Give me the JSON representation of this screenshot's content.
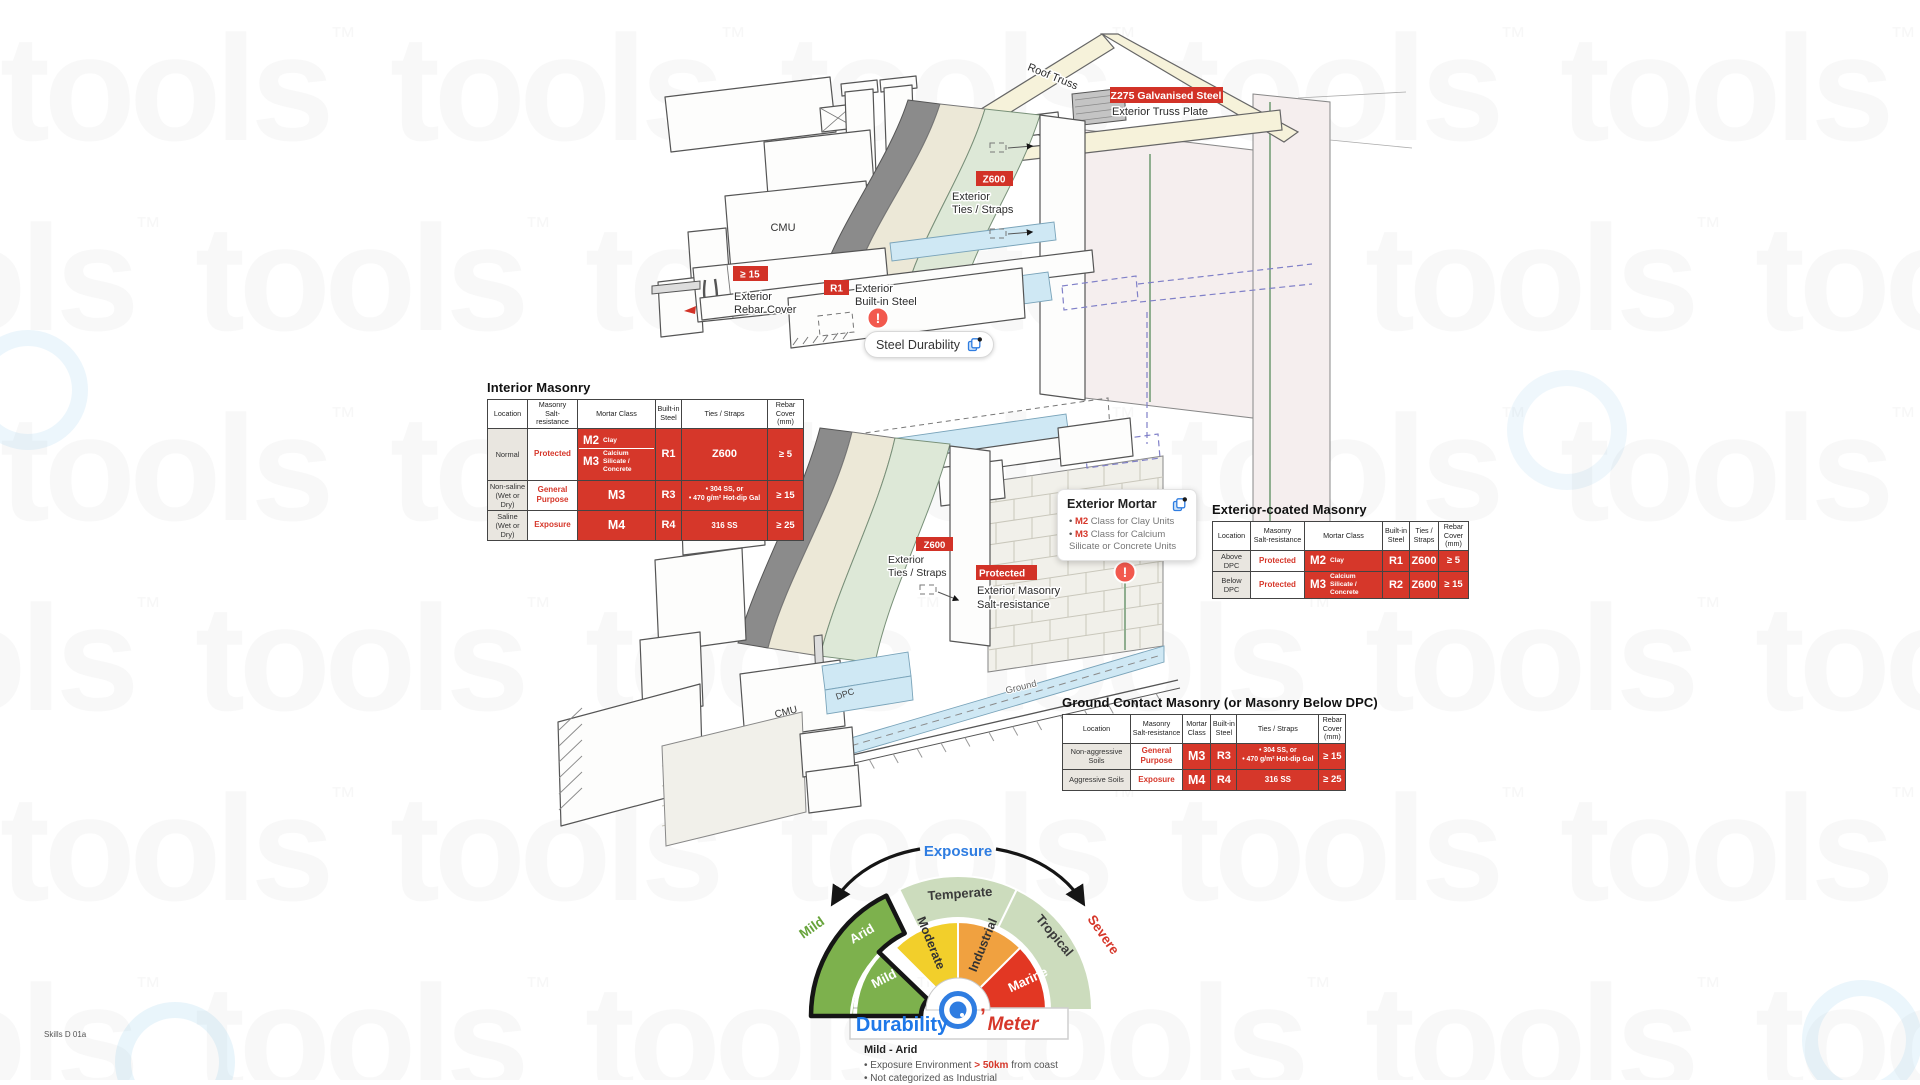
{
  "meta": {
    "footer_code": "Skills D 01a",
    "watermark": "tools"
  },
  "colors": {
    "badge_red": "#d23227",
    "table_red": "#d6372a",
    "accent_blue": "#2f7de1",
    "warn_red": "#f2594e",
    "green_sel": "#7db14d",
    "green_pale": "#ccdcbd",
    "yellow": "#f2cf2b",
    "orange": "#f0a140",
    "marine": "#e23723",
    "label_green": "#67a33a",
    "label_red": "#d6372a",
    "brand_blue": "#1e78e8"
  },
  "diagram": {
    "roof_truss": "Roof Truss",
    "z275_badge": "Z275 Galvanised Steel",
    "truss_plate": "Exterior Truss Plate",
    "cmu_upper": "CMU",
    "cmu_lower": "CMU",
    "dpc": "DPC",
    "ground": "Ground",
    "ties_upper": {
      "badge": "Z600",
      "l1": "Exterior",
      "l2": "Ties / Straps"
    },
    "ties_lower": {
      "badge": "Z600",
      "l1": "Exterior",
      "l2": "Ties / Straps"
    },
    "rebar": {
      "badge": "≥ 15",
      "l1": "Exterior",
      "l2": "Rebar Cover"
    },
    "builtin": {
      "badge": "R1",
      "l1": "Exterior",
      "l2": "Built-in Steel"
    },
    "salt": {
      "badge": "Protected",
      "l1": "Exterior Masonry",
      "l2": "Salt-resistance"
    },
    "steel_durability": "Steel Durability",
    "warning": "!",
    "mortar_card": {
      "title": "Exterior Mortar",
      "b1_code": "M2",
      "b1_text": " Class for Clay Units",
      "b2_code": "M3",
      "b2_text": " Class for Calcium Silicate or Concrete Units"
    }
  },
  "tables": [
    {
      "id": "interior",
      "title": "Interior Masonry",
      "headers": [
        "Location",
        "Masonry\nSalt-resistance",
        "Mortar Class",
        "Built-in\nSteel",
        "Ties / Straps",
        "Rebar\nCover\n(mm)"
      ],
      "rows": [
        {
          "location": "Normal",
          "salt": "Protected",
          "mortar": [
            {
              "code": "M2",
              "desc": "Clay"
            },
            {
              "code": "M3",
              "desc": "Calcium Silicate /\nConcrete"
            }
          ],
          "steel": "R1",
          "ties": [
            "Z600"
          ],
          "ties_style": "big",
          "rebar": "≥ 5"
        },
        {
          "location": "Non-saline\n(Wet or Dry)",
          "salt": "General\nPurpose",
          "mortar": [
            {
              "code": "M3",
              "desc": ""
            }
          ],
          "steel": "R3",
          "ties": [
            "• 304 SS, or",
            "• 470 g/m² Hot-dip Gal"
          ],
          "ties_style": "list",
          "rebar": "≥ 15"
        },
        {
          "location": "Saline\n(Wet or Dry)",
          "salt": "Exposure",
          "mortar": [
            {
              "code": "M4",
              "desc": ""
            }
          ],
          "steel": "R4",
          "ties": [
            "316 SS"
          ],
          "ties_style": "med",
          "rebar": "≥ 25"
        }
      ]
    },
    {
      "id": "exterior",
      "title": "Exterior-coated Masonry",
      "headers": [
        "Location",
        "Masonry\nSalt-resistance",
        "Mortar Class",
        "Built-in\nSteel",
        "Ties /\nStraps",
        "Rebar\nCover\n(mm)"
      ],
      "rows": [
        {
          "location": "Above DPC",
          "salt": "Protected",
          "mortar": [
            {
              "code": "M2",
              "desc": "Clay"
            }
          ],
          "steel": "R1",
          "ties": [
            "Z600"
          ],
          "ties_style": "big",
          "rebar": "≥ 5"
        },
        {
          "location": "Below DPC",
          "salt": "Protected",
          "mortar": [
            {
              "code": "M3",
              "desc": "Calcium Silicate /\nConcrete"
            }
          ],
          "steel": "R2",
          "ties": [
            "Z600"
          ],
          "ties_style": "big",
          "rebar": "≥ 15"
        }
      ]
    },
    {
      "id": "ground",
      "title": "Ground Contact Masonry (or Masonry Below DPC)",
      "headers": [
        "Location",
        "Masonry\nSalt-resistance",
        "Mortar\nClass",
        "Built-in\nSteel",
        "Ties / Straps",
        "Rebar\nCover\n(mm)"
      ],
      "rows": [
        {
          "location": "Non-aggressive Soils",
          "salt": "General\nPurpose",
          "mortar": [
            {
              "code": "M3",
              "desc": ""
            }
          ],
          "steel": "R3",
          "ties": [
            "• 304 SS, or",
            "• 470 g/m² Hot-dip Gal"
          ],
          "ties_style": "list",
          "rebar": "≥ 15"
        },
        {
          "location": "Aggressive Soils",
          "salt": "Exposure",
          "mortar": [
            {
              "code": "M4",
              "desc": ""
            }
          ],
          "steel": "R4",
          "ties": [
            "316 SS"
          ],
          "ties_style": "med",
          "rebar": "≥ 25"
        }
      ]
    }
  ],
  "gauge": {
    "exposure_label": "Exposure",
    "left_label": "Mild",
    "right_label": "Severe",
    "outer": [
      {
        "label": "Arid",
        "selected": true
      },
      {
        "label": "Temperate",
        "selected": false
      },
      {
        "label": "Tropical",
        "selected": false
      }
    ],
    "inner": [
      {
        "label": "Mild",
        "selected": true
      },
      {
        "label": "Moderate",
        "selected": false
      },
      {
        "label": "Industrial",
        "selected": false
      },
      {
        "label": "Marine",
        "selected": false
      }
    ],
    "brand_left": "Durability",
    "brand_mark": "’",
    "brand_right": "Meter",
    "result_heading": "Mild - Arid",
    "bullet1_pre": "Exposure Environment ",
    "bullet1_em": "> 50km",
    "bullet1_post": " from coast",
    "bullet2": "Not categorized as Industrial"
  }
}
